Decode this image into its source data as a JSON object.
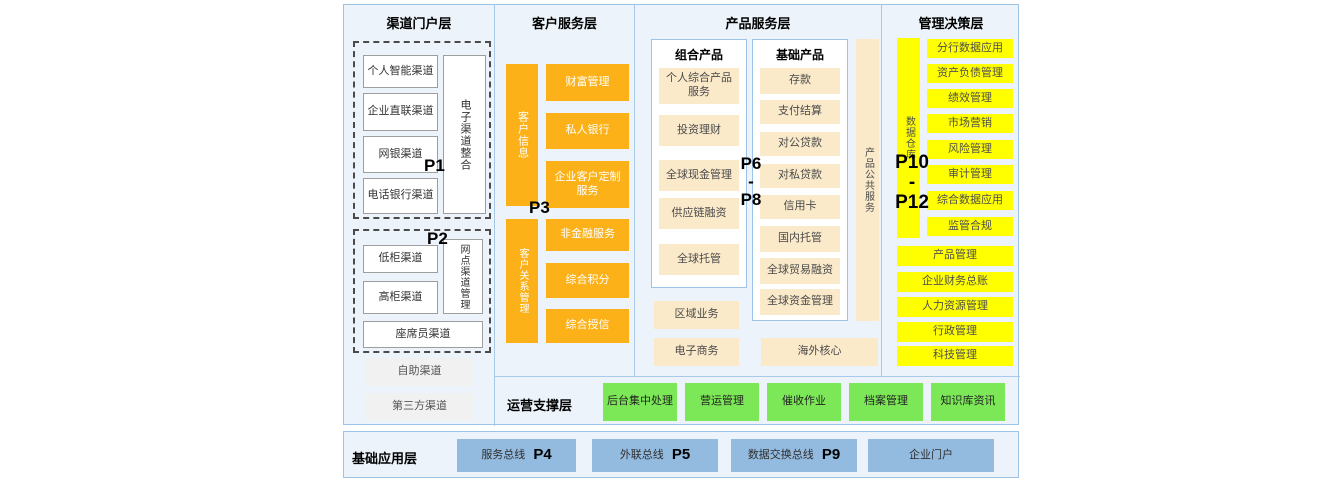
{
  "portal": {
    "title": "渠道门户层",
    "p1": "P1",
    "p2": "P2",
    "group1": {
      "items": [
        "个人智能渠道",
        "企业直联渠道",
        "网银渠道",
        "电话银行渠道"
      ],
      "side": "电子渠道整合"
    },
    "group2": {
      "items": [
        "低柜渠道",
        "高柜渠道"
      ],
      "side": "网点渠道管理",
      "bottom": "座席员渠道"
    },
    "extra": [
      "自助渠道",
      "第三方渠道"
    ]
  },
  "customer": {
    "title": "客户服务层",
    "p3": "P3",
    "bar1": "客户信息",
    "bar1_items": [
      "财富管理",
      "私人银行",
      "企业客户定制服务"
    ],
    "bar2": "客户关系管理",
    "bar2_items": [
      "非金融服务",
      "综合积分",
      "综合授信"
    ]
  },
  "product": {
    "title": "产品服务层",
    "p_top": "P6",
    "p_sep": "-",
    "p_bottom": "P8",
    "combo_title": "组合产品",
    "combo_items": [
      "个人综合产品服务",
      "投资理财",
      "全球现金管理",
      "供应链融资",
      "全球托管"
    ],
    "basic_title": "基础产品",
    "basic_items": [
      "存款",
      "支付结算",
      "对公贷款",
      "对私贷款",
      "信用卡",
      "国内托管",
      "全球贸易融资",
      "全球资金管理"
    ],
    "side": "产品公共服务",
    "extra": [
      "区域业务",
      "电子商务"
    ],
    "overseas": "海外核心"
  },
  "management": {
    "title": "管理决策层",
    "p_top": "P10",
    "p_sep": "-",
    "p_bottom": "P12",
    "warehouse": "数据仓库",
    "apps": [
      "分行数据应用",
      "资产负债管理",
      "绩效管理",
      "市场营销",
      "风险管理",
      "审计管理",
      "综合数据应用",
      "监管合规"
    ],
    "wide": [
      "产品管理",
      "企业财务总账",
      "人力资源管理",
      "行政管理",
      "科技管理"
    ]
  },
  "operations": {
    "title": "运营支撑层",
    "items": [
      "后台集中处理",
      "营运管理",
      "催收作业",
      "档案管理",
      "知识库资讯"
    ]
  },
  "foundation": {
    "title": "基础应用层",
    "items": [
      {
        "label": "服务总线",
        "p": "P4"
      },
      {
        "label": "外联总线",
        "p": "P5"
      },
      {
        "label": "数据交换总线",
        "p": "P9"
      },
      {
        "label": "企业门户",
        "p": ""
      }
    ]
  },
  "colors": {
    "orange": "#FBB117",
    "cream": "#FBEACA",
    "yellow": "#FFFF00",
    "green": "#7CE857",
    "blue": "#93BADF",
    "panel_bg": "#EDF3FA",
    "panel_border": "#9DC3E6"
  }
}
